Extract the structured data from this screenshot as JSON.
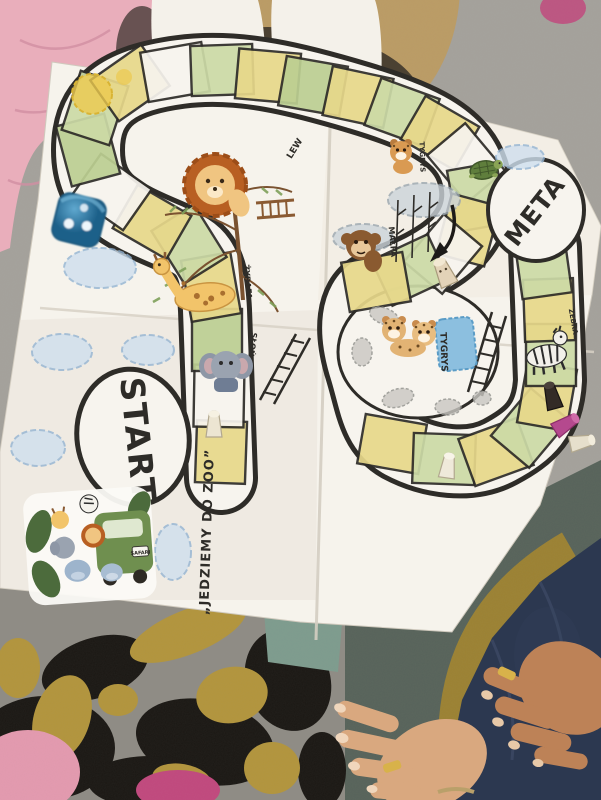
{
  "scene": {
    "type": "photograph",
    "subject": "hand-drawn children's zoo board game poster on a carpet, with dice, pawns and animal stickers"
  },
  "board": {
    "title": "„JEDZIEMY DO ZOO”",
    "start": "START",
    "meta": "META",
    "labels": {
      "lion": "LEW",
      "giraffe": "ŻYRAFA",
      "elephant": "SŁOŃ",
      "monkey": "MAŁPA",
      "tiger": "TYGRYS",
      "tiger_cub": "TYGRYS",
      "zebra": "ZEBRA"
    },
    "bus_plate": "SAFARI"
  },
  "pieces": {
    "dice_color_name": "blue",
    "dice_pips_visible": 3,
    "pawns": [
      "white",
      "cream",
      "white",
      "black",
      "pink",
      "white"
    ],
    "figurine": "turtle"
  },
  "colors": {
    "paper": "#f6f3ec",
    "ink": "#2e2c28",
    "cellYellow": "#e7d88a",
    "cellGreen": "#ccdaa6",
    "cellOlive": "#bccf92",
    "cellWhite": "#f7f4ee",
    "carpetGray": "#a5a29c",
    "carpetTan": "#bd9c62",
    "carpetTeal": "#7e9c8e",
    "carpetDark": "#57635a",
    "leopardBase": "#8f8c85",
    "leopardBlack": "#1a1713",
    "leopardMustard": "#b3953c",
    "mustardArc": "#a08430",
    "blanketPink": "#e9aebb",
    "spotPink": "#c2487e",
    "jeans": "#2c3850",
    "skinDark": "#bd8257",
    "skinLight": "#d9a87f",
    "diceBlue": "#2f86b8",
    "water": "#7fb9dd",
    "cloud": "#b9cfe2",
    "sun": "#ecc94e",
    "ringGold": "#d8b24a",
    "sockWhite": "#f4f1ea"
  }
}
